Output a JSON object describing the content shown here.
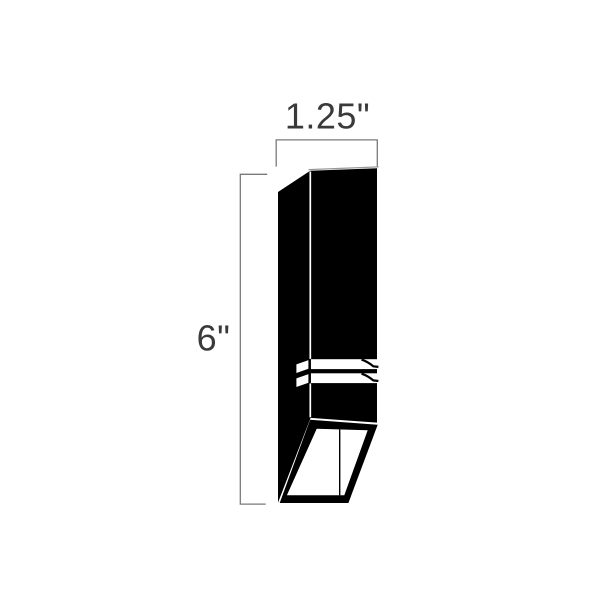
{
  "drawing": {
    "width_label": "1.25\"",
    "height_label": "6\"",
    "colors": {
      "fixture": "#000000",
      "aperture": "#ffffff",
      "dimension_line": "#7a7a7a",
      "dimension_text": "#3a3a3a",
      "edge_highlight": "#9a9a9a",
      "background": "#ffffff"
    }
  }
}
